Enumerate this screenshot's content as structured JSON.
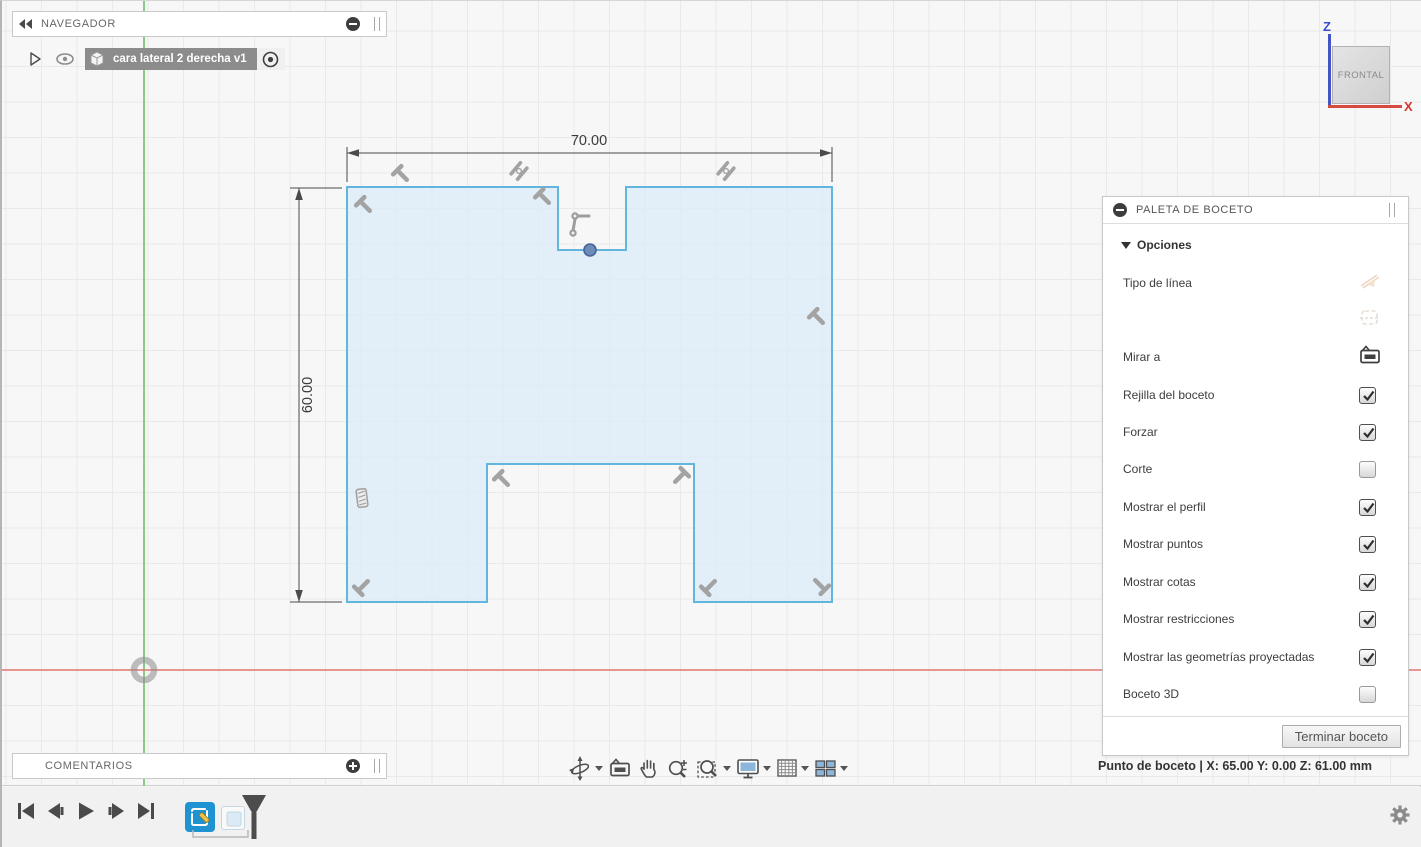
{
  "navigator": {
    "title": "NAVEGADOR",
    "item": "cara lateral 2 derecha v1"
  },
  "comments": {
    "title": "COMENTARIOS"
  },
  "viewcube": {
    "face": "FRONTAL",
    "axis_z": "Z",
    "axis_x": "X"
  },
  "sketch": {
    "dim_width": "70.00",
    "dim_height": "60.00",
    "outline_color": "#62b5dd",
    "fill_color": "#e2eff9",
    "point_color": "#6d8cba"
  },
  "palette": {
    "title": "PALETA DE BOCETO",
    "section": "Opciones",
    "rows": [
      {
        "label": "Tipo de línea",
        "checked": null
      },
      {
        "label": "Mirar a",
        "checked": null
      },
      {
        "label": "Rejilla del boceto",
        "checked": true
      },
      {
        "label": "Forzar",
        "checked": true
      },
      {
        "label": "Corte",
        "checked": false
      },
      {
        "label": "Mostrar el perfil",
        "checked": true
      },
      {
        "label": "Mostrar puntos",
        "checked": true
      },
      {
        "label": "Mostrar cotas",
        "checked": true
      },
      {
        "label": "Mostrar restricciones",
        "checked": true
      },
      {
        "label": "Mostrar las geometrías proyectadas",
        "checked": true
      },
      {
        "label": "Boceto 3D",
        "checked": false
      }
    ],
    "finish": "Terminar boceto"
  },
  "status": {
    "text": "Punto de boceto | X: 65.00 Y: 0.00 Z: 61.00 mm"
  },
  "colors": {
    "axis_x": "#e2766d",
    "axis_y_vertical": "#6cc06b",
    "timeline_feature": "#1f93d1"
  }
}
